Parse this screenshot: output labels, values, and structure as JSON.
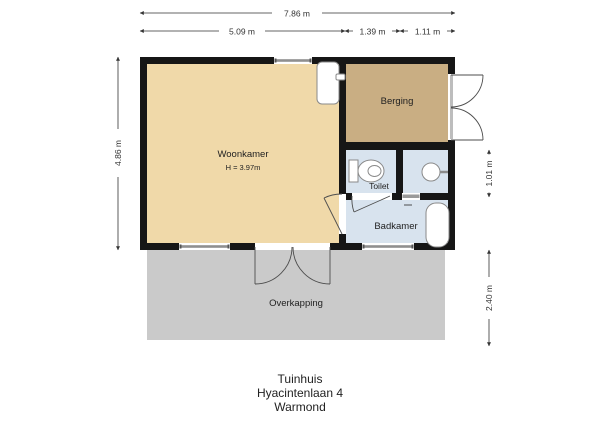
{
  "plan": {
    "rooms": {
      "woonkamer": {
        "label": "Woonkamer",
        "height_note": "H = 3.97m",
        "floor_color": "#f0d9a9"
      },
      "berging": {
        "label": "Berging",
        "floor_color": "#c9ae83"
      },
      "toilet": {
        "label": "Toilet",
        "floor_color": "#d8e3ee"
      },
      "badkamer": {
        "label": "Badkamer",
        "floor_color": "#d8e3ee"
      },
      "overkapping": {
        "label": "Overkapping",
        "floor_color": "#cacaca"
      }
    },
    "fixtures": [
      {
        "name": "toilet-icon"
      },
      {
        "name": "washbasin-icon"
      },
      {
        "name": "bathtub-icon"
      },
      {
        "name": "boiler-icon"
      }
    ],
    "colors": {
      "wall": "#161616",
      "window": "#8f8f8f",
      "window_end": "#555555",
      "opening": "#ffffff",
      "threshold": "#9a9a9a",
      "door_line": "#4d4d4d",
      "dimension_line": "#333333",
      "fixture_stroke": "#8a8a8a",
      "fixture_fill": "#ffffff",
      "text": "#222222",
      "background": "#ffffff"
    }
  },
  "dimensions": {
    "top_total": "7.86 m",
    "top_left": "5.09 m",
    "top_mid": "1.39 m",
    "top_right": "1.11 m",
    "left_height": "4.86 m",
    "right_upper": "1.01 m",
    "right_lower": "2.40 m"
  },
  "title_block": {
    "building": "Tuinhuis",
    "address": "Hyacintenlaan 4",
    "city": "Warmond"
  }
}
